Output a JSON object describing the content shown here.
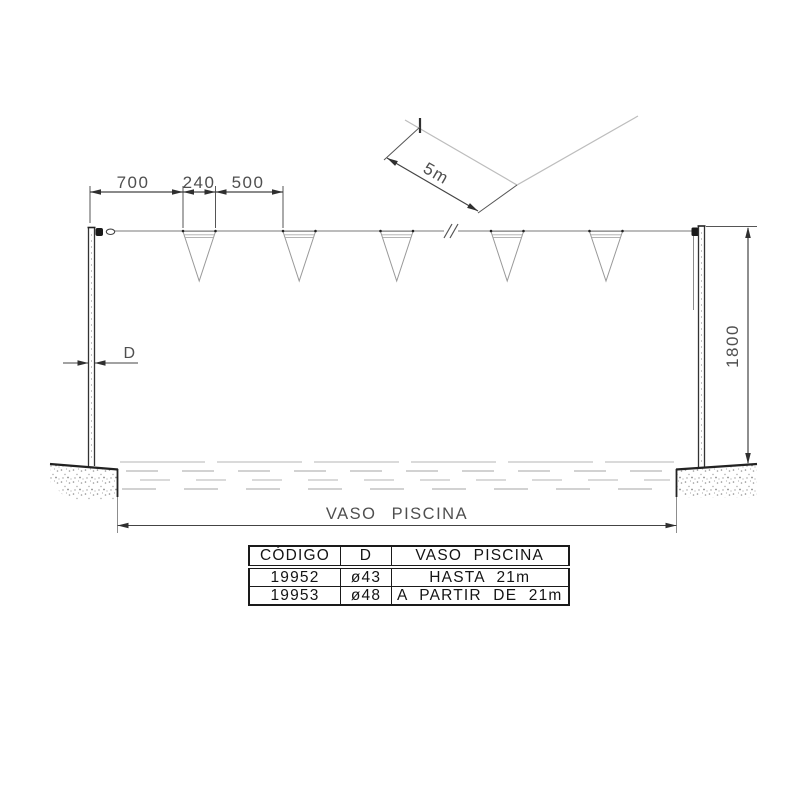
{
  "labels": {
    "dim_700": "700",
    "dim_240": "240",
    "dim_500": "500",
    "dim_5m": "5m",
    "dim_post_diameter": "D",
    "dim_1800": "1800",
    "dim_vaso_piscina": "VASO PISCINA"
  },
  "table": {
    "headers": [
      "CÓDIGO",
      "D",
      "VASO PISCINA"
    ],
    "rows": [
      [
        "19952",
        "ø43",
        "HASTA 21m"
      ],
      [
        "19953",
        "ø48",
        "A PARTIR DE 21m"
      ]
    ]
  },
  "colors": {
    "line_dark": "#2f2f2f",
    "line_medium": "#555555",
    "line_light": "#c4c4c4",
    "dim_text": "#4f4f4f",
    "background": "#ffffff"
  }
}
